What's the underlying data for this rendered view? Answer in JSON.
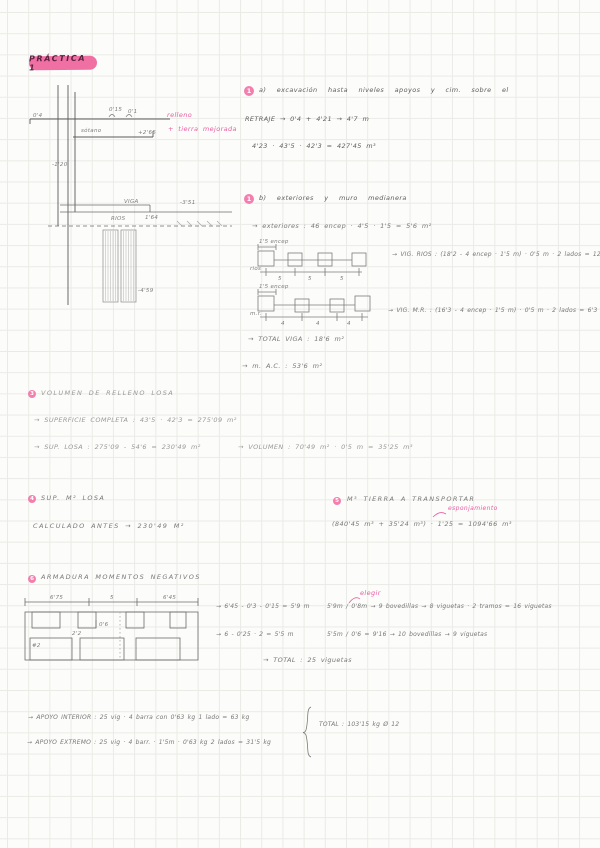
{
  "page": {
    "title": "PRÁCTICA 1"
  },
  "drawing1": {
    "d_04": "0'4",
    "d_015": "0'15",
    "d_01": "0'1",
    "sotano": "sótano",
    "d_265": "+2'65",
    "relleno": "relleno",
    "tierra": "+ tierra mejorada",
    "d_120": "-1'20",
    "viga": "VIGA",
    "rios": "RIOS",
    "d_164": "1'64",
    "d_351": "-3'51",
    "d_459": "-4'59"
  },
  "s1a": {
    "num": "1",
    "title": "a) excavación hasta niveles apoyos y cim. sobre el",
    "line1": "RETRAJE  →  0'4 + 4'21  →  4'7 m",
    "line2": "4'23 · 43'5 · 42'3  =  427'45 m³"
  },
  "s1b": {
    "num": "1",
    "title": "b) exteriores y muro medianera",
    "line1": "→ exteriores :  46 encep · 4'5 · 1'5 = 5'6 m²",
    "diagA_label": "1'5 encep",
    "diagA_note": "rios",
    "diagA_dims": [
      "5",
      "5",
      "5"
    ],
    "vig_rios": "→ VIG. RIOS : (18'2 - 4 encep · 1'5 m) · 0'5 m · 2 lados = 12'3 m²",
    "diagB_label": "1'5 encep",
    "diagB_note": "m.r.",
    "diagB_dims": [
      "4",
      "4",
      "4"
    ],
    "vig_mr": "→ VIG. M.R. : (16'3 - 4 encep · 1'5 m) · 0'5 m · 2 lados = 6'3 m²",
    "total": "→ TOTAL  VIGA :  18'6 m²",
    "mac": "→ m. A.C. :  53'6 m²"
  },
  "s3": {
    "num": "3",
    "title": "VOLUMEN  DE  RELLENO  LOSA",
    "line1": "→ SUPERFICIE  COMPLETA :  43'5 · 42'3  =  275'09 m²",
    "line2": "→ SUP.  LOSA :  275'09 - 54'6  =  230'49 m²",
    "line3": "→ VOLUMEN :  70'49 m² · 0'5 m  =  35'25 m³"
  },
  "s4": {
    "num": "4",
    "title": "SUP.  M²  LOSA",
    "line1": "CALCULADO   ANTES   →   230'49 m²"
  },
  "s5": {
    "num": "5",
    "title": "M³  TIERRA  A  TRANSPORTAR",
    "note": "esponjamiento",
    "line1": "(840'45 m³ + 35'24 m³) · 1'25  =  1094'66 m³"
  },
  "s6": {
    "num": "6",
    "title": "ARMADURA  MOMENTOS  NEGATIVOS",
    "note": "elegir",
    "dims": [
      "6'75",
      "5",
      "6'45"
    ],
    "d_06": "0'6",
    "d_22": "2'2",
    "hash2": "#2",
    "calc1": "→ 6'45 - 0'3 - 0'15 = 5'9 m",
    "res1": "5'9m / 0'8m → 9 bovedillas → 8 viguetas · 2 tramos = 16 viguetas",
    "calc2": "→ 6 - 0'25 · 2  =  5'5 m",
    "res2": "5'5m / 0'6 = 9'16 → 10 bovedillas  →  9 viguetas",
    "total": "→ TOTAL :  25 viguetas"
  },
  "s7": {
    "line1": "→ APOYO INTERIOR :  25 vig · 4 barra con 0'63 kg  1 lado  =  63 kg",
    "line2": "→ APOYO EXTREMO :  25 vig · 4 barr. · 1'5m · 0'63 kg  2 lados  =  31'5 kg",
    "total": "TOTAL :  103'15 kg    Ø 12"
  }
}
